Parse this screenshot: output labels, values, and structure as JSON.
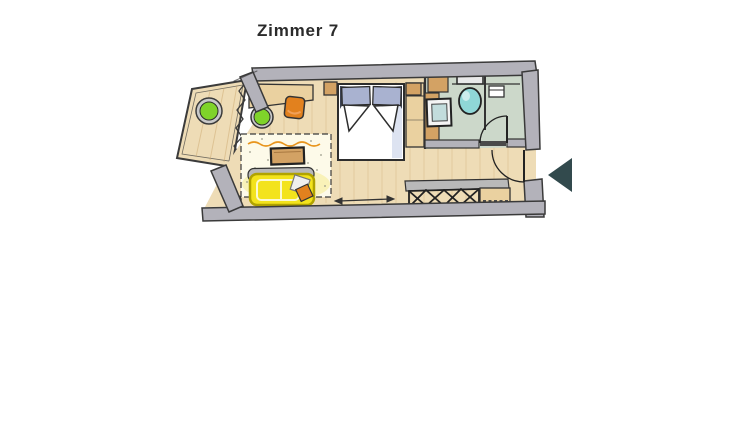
{
  "title": {
    "text": "Zimmer 7"
  },
  "nav": {
    "prev_label": "previous"
  },
  "palette": {
    "ink": "#343434",
    "wall": "#b3b2ba",
    "floor": "#eedcb6",
    "plank": "#c9a469",
    "bath_floor": "#ccd8ca",
    "wood": "#d3a264",
    "wood_light": "#ead1a0",
    "green": "#7fd32a",
    "stool_rim": "#c9c9c9",
    "orange": "#e2811e",
    "yellow": "#f3e31c",
    "yellow_edge": "#b1a300",
    "rug": "#fdfae9",
    "rug_glow": "#f4e87c",
    "pillow": "#a9b2d0",
    "duvet_shade": "#dde3f1",
    "dark_fold": "#3d4354",
    "teal": "#8fd7d7",
    "sink": "#c2dcdc",
    "gray_furniture": "#b9b9b9",
    "threshold": "#4a4a4a",
    "arrow": "#324a4d",
    "white": "#ffffff"
  },
  "plan": {
    "room_label": "Zimmer 7",
    "areas": [
      "balcony",
      "sleeping-living-area",
      "bathroom",
      "entry"
    ],
    "furniture": [
      "balcony-table",
      "stool",
      "desk",
      "desk-chair",
      "double-bed",
      "nightstand",
      "wardrobe",
      "rug",
      "coffee-table",
      "sofa",
      "floor-lamp",
      "vanity-sink",
      "toilet",
      "wall-shelf",
      "luggage-rack",
      "bench"
    ]
  }
}
